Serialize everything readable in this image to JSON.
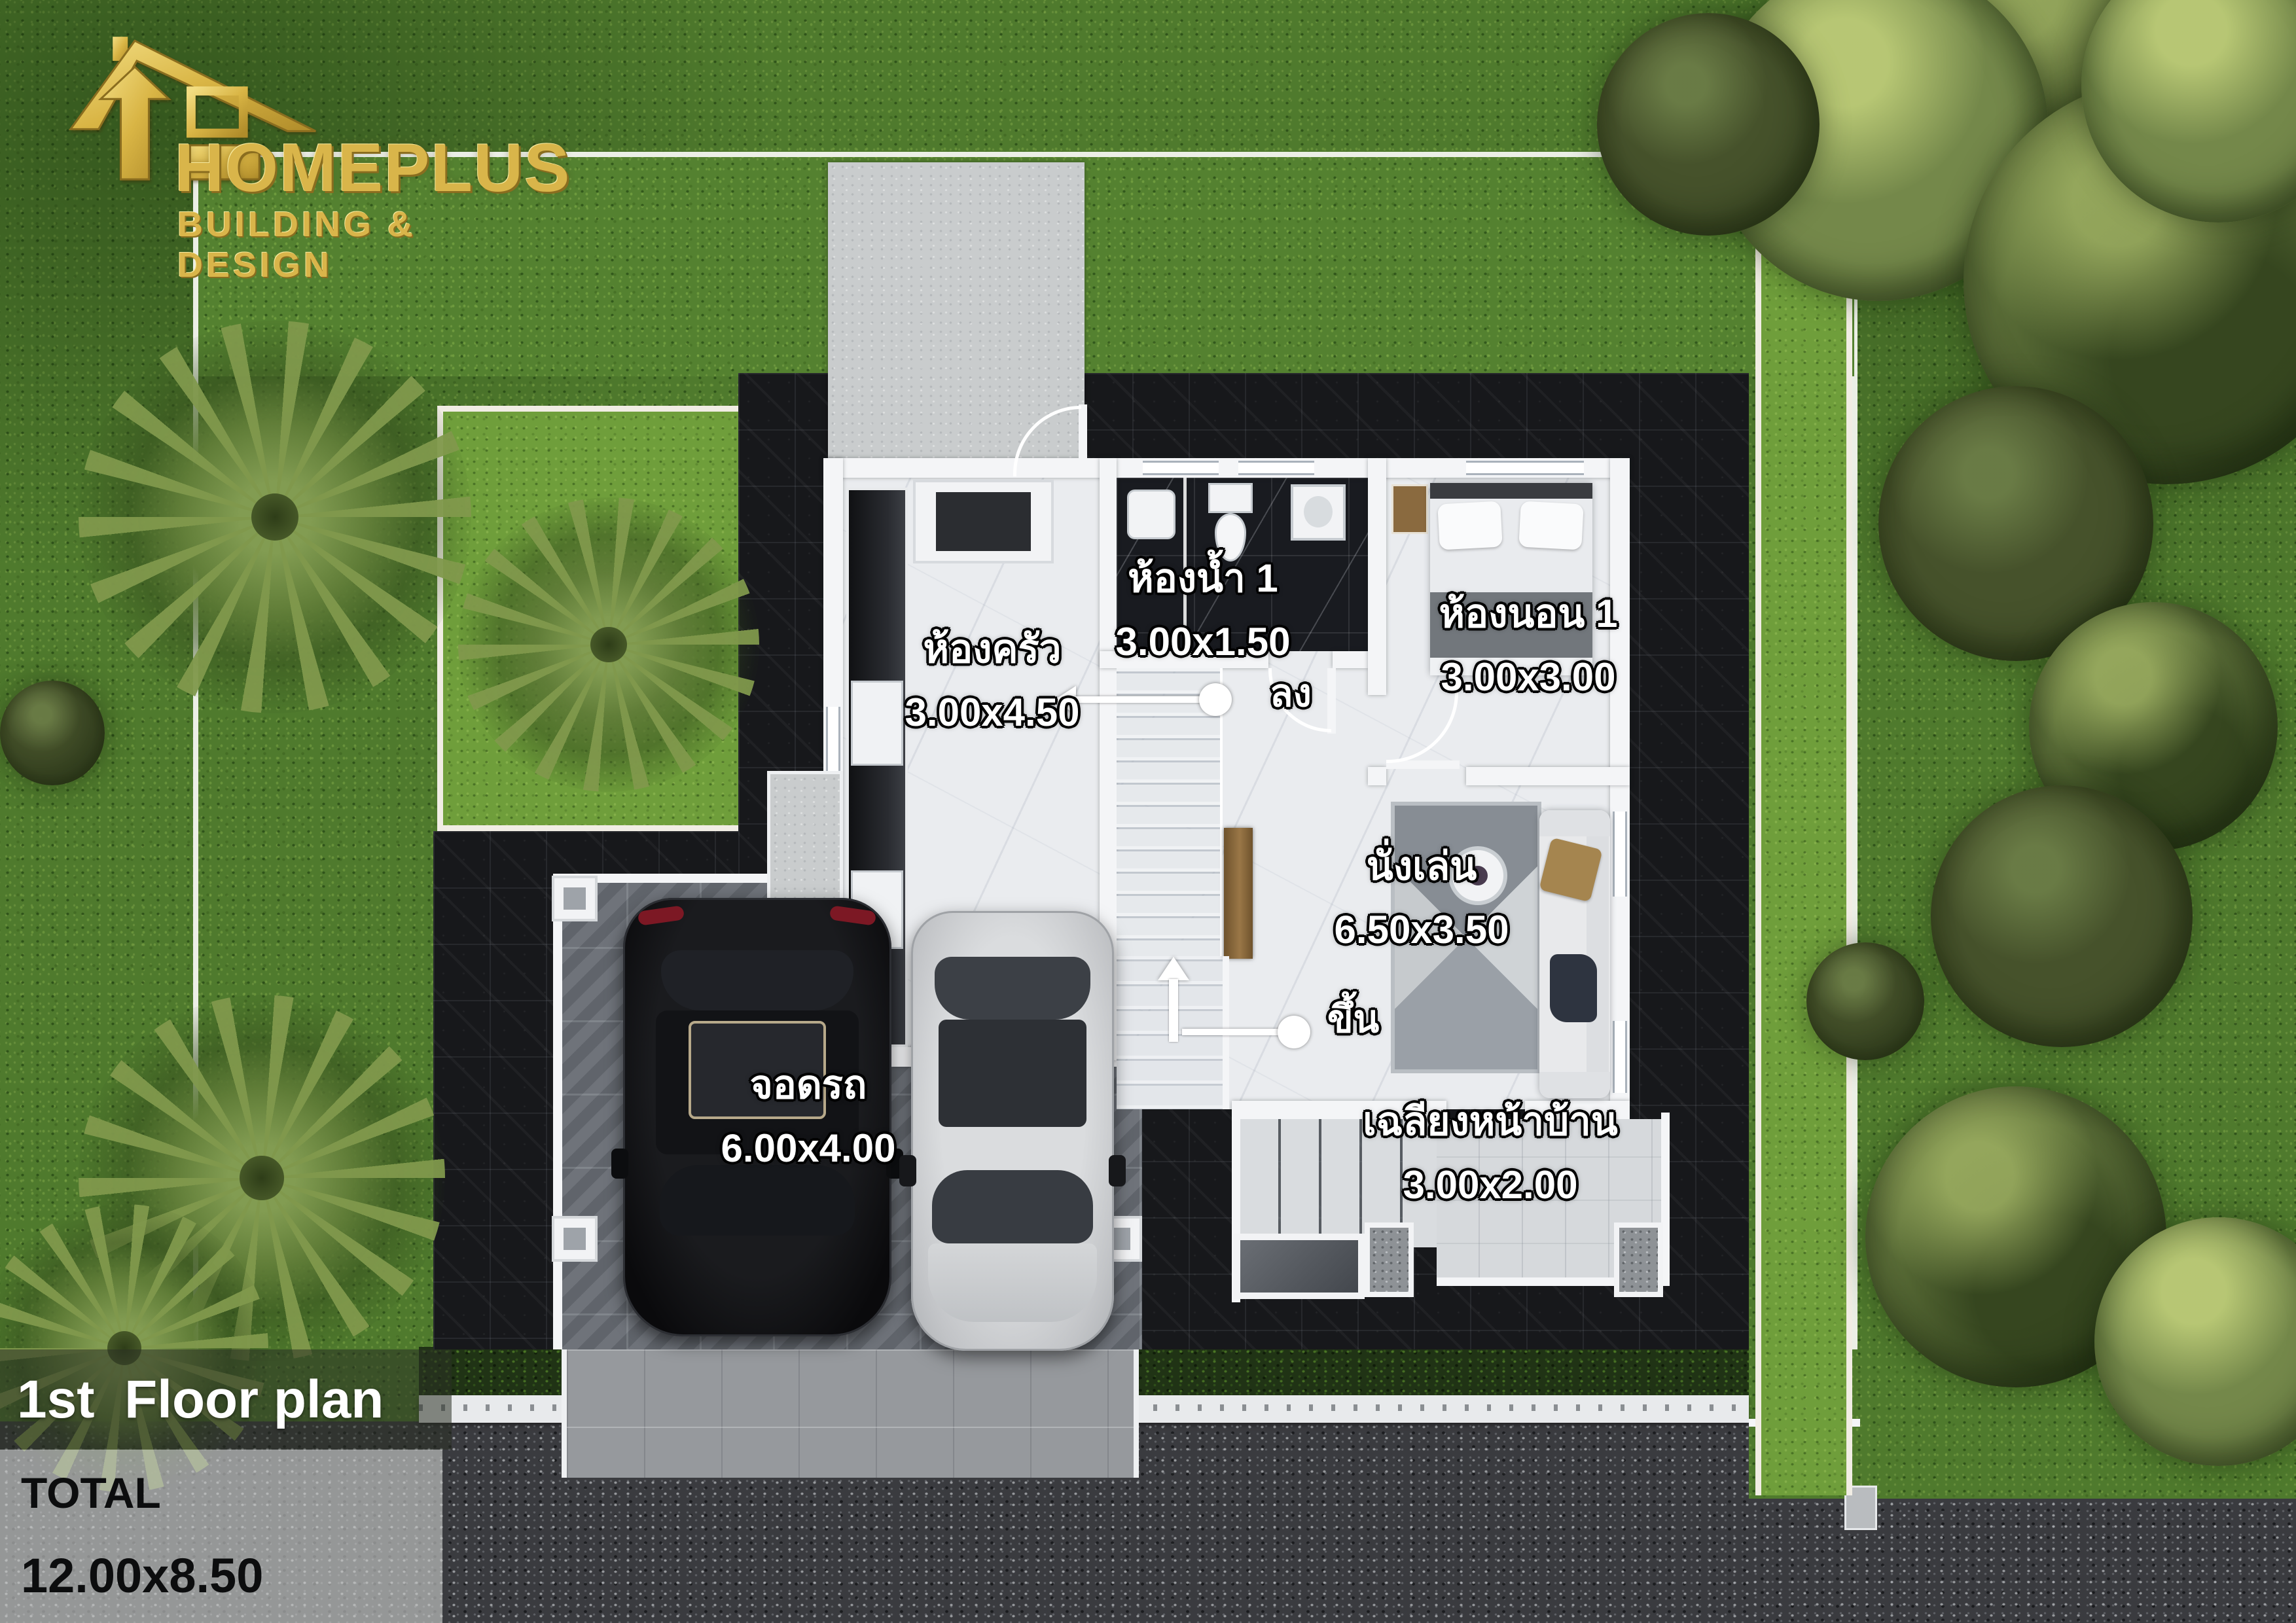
{
  "logo": {
    "brand": "HOMEPLUS",
    "tagline": "BUILDING & DESIGN",
    "icon": "house-arrow-icon",
    "gold": "#d9b54a"
  },
  "plan": {
    "rooms": [
      {
        "key": "kitchen",
        "name": "ห้องครัว",
        "size": "3.00x4.50"
      },
      {
        "key": "bathroom1",
        "name": "ห้องน้ำ 1",
        "size": "3.00x1.50"
      },
      {
        "key": "bedroom1",
        "name": "ห้องนอน 1",
        "size": "3.00x3.00"
      },
      {
        "key": "living",
        "name": "นั่งเล่น",
        "size": "6.50x3.50"
      },
      {
        "key": "carport",
        "name": "จอดรถ",
        "size": "6.00x4.00"
      },
      {
        "key": "porch",
        "name": "เฉลียงหน้าบ้าน",
        "size": "3.00x2.00"
      }
    ],
    "stair_down": "ลง",
    "stair_up": "ขึ้น"
  },
  "footer": {
    "title": "1st  Floor plan",
    "total_label": "TOTAL",
    "total_size": "12.00x8.50"
  },
  "colors": {
    "logo_gold": "#d9b54a",
    "label_text": "#ffffff",
    "label_outline": "#000000",
    "footer_title_bg": "rgba(42,48,36,0.55)",
    "footer_total_bg": "rgba(198,199,197,0.66)"
  }
}
